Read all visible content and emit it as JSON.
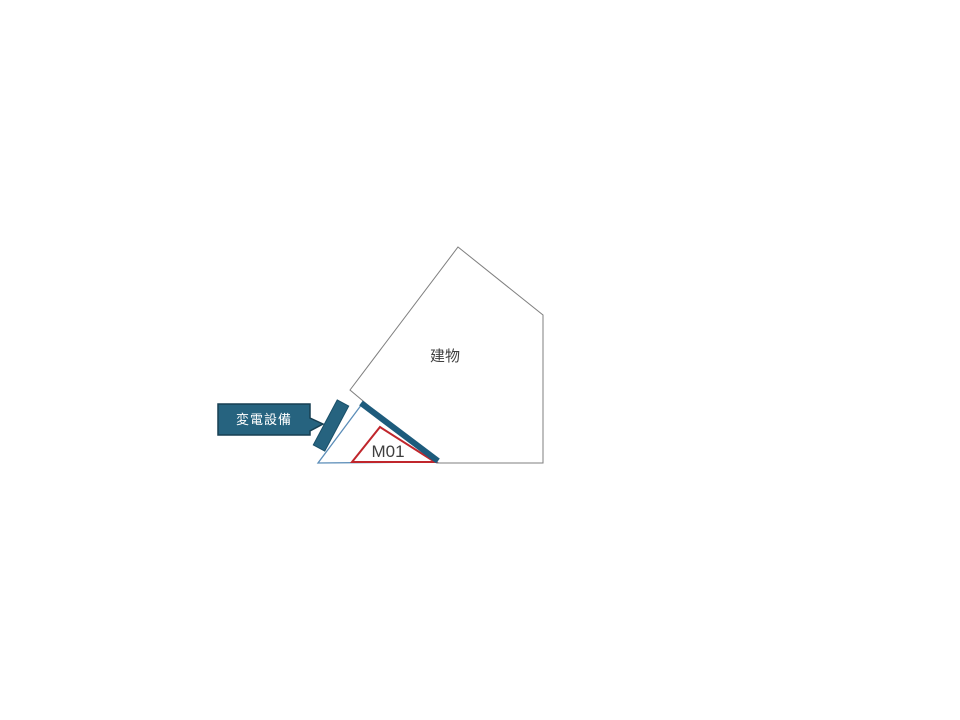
{
  "slide": {
    "building": {
      "label": "建物"
    },
    "zone": {
      "label": "M01"
    },
    "callout": {
      "label": "変電設備"
    },
    "colors": {
      "background": "#ffffff",
      "building_outline": "#7f7f7f",
      "yard_outline": "#5b8db8",
      "barrier_bar": "#1d5b7c",
      "zone_red": "#c0262c",
      "equipment_fill": "#26637f",
      "equipment_stroke": "#194f68",
      "callout_fill": "#26637f",
      "callout_stroke": "#173f52",
      "text_dark": "#3f3f3f",
      "text_light": "#ffffff",
      "shape_fill": "#ffffff"
    }
  }
}
